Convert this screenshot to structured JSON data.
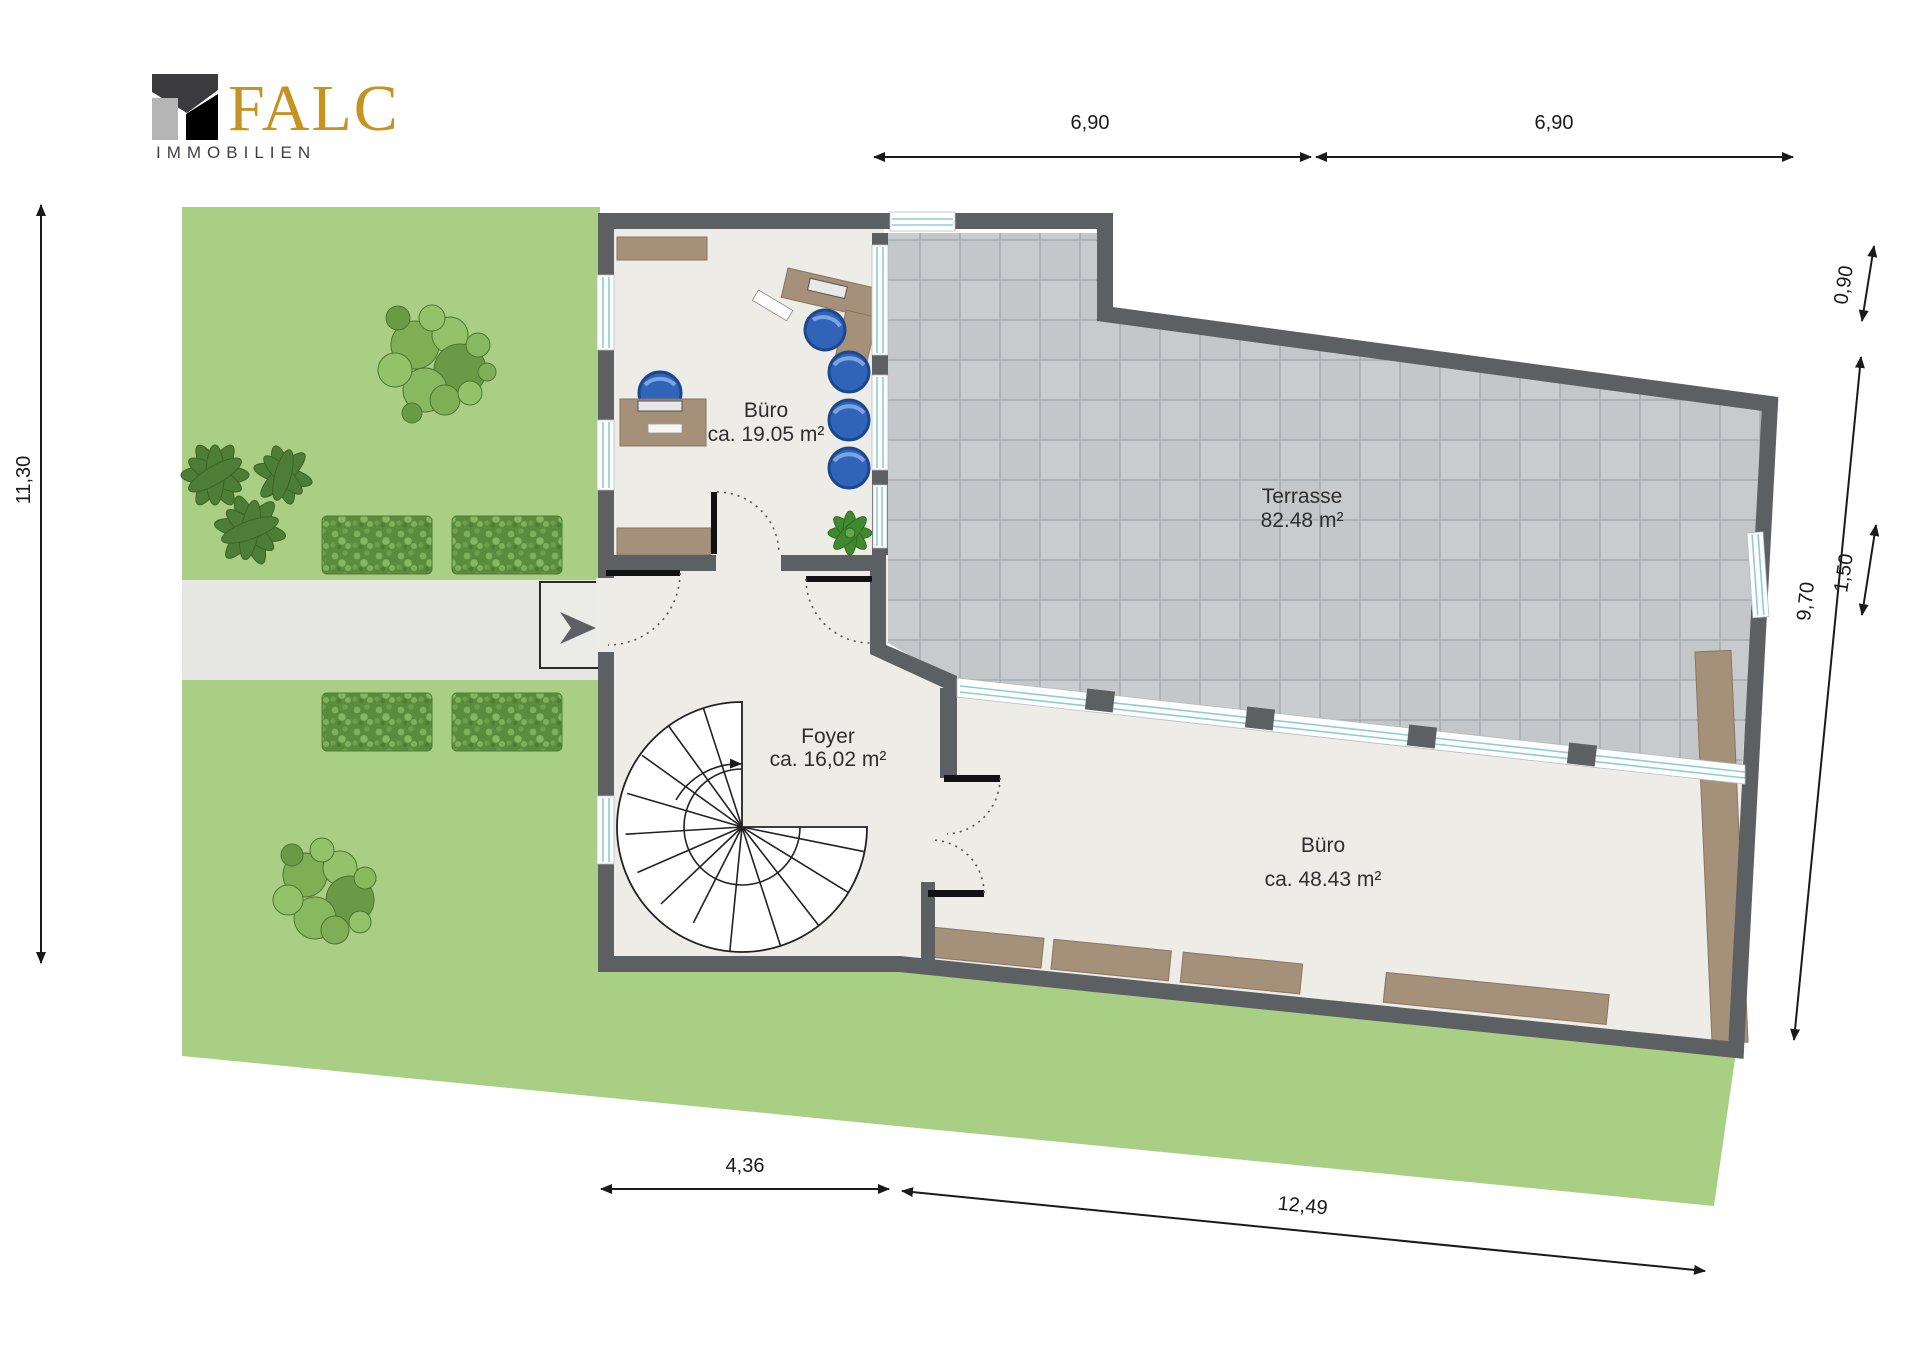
{
  "logo": {
    "brand": "FALC",
    "subtitle": "IMMOBILIEN"
  },
  "rooms": {
    "office_top": {
      "name": "Büro",
      "area": "ca. 19.05 m²"
    },
    "terrace": {
      "name": "Terrasse",
      "area": "82.48 m²"
    },
    "foyer": {
      "name": "Foyer",
      "area": "ca. 16,02 m²"
    },
    "office_main": {
      "name": "Büro",
      "area": "ca. 48.43 m²"
    }
  },
  "dimensions": {
    "top_left": "6,90",
    "top_right": "6,90",
    "left": "11,30",
    "right_upper": "0,90",
    "right_long": "9,70",
    "right_inner": "1,50",
    "bottom_left": "4,36",
    "bottom_right": "12,49"
  },
  "colors": {
    "wall": "#5d6063",
    "floor": "#edece7",
    "terrace_tile": "#c3c7ca",
    "grass": "#a9cf84",
    "hedge": "#5a8c3e",
    "walkway": "#e6e6e3",
    "wood": "#a5907a",
    "chair_blue": "#2f64b8",
    "window_glass": "#8ecdd2",
    "brand_gold": "#c6941e",
    "brand_dark": "#3b3b3e",
    "brand_gray": "#b5b5b6"
  }
}
